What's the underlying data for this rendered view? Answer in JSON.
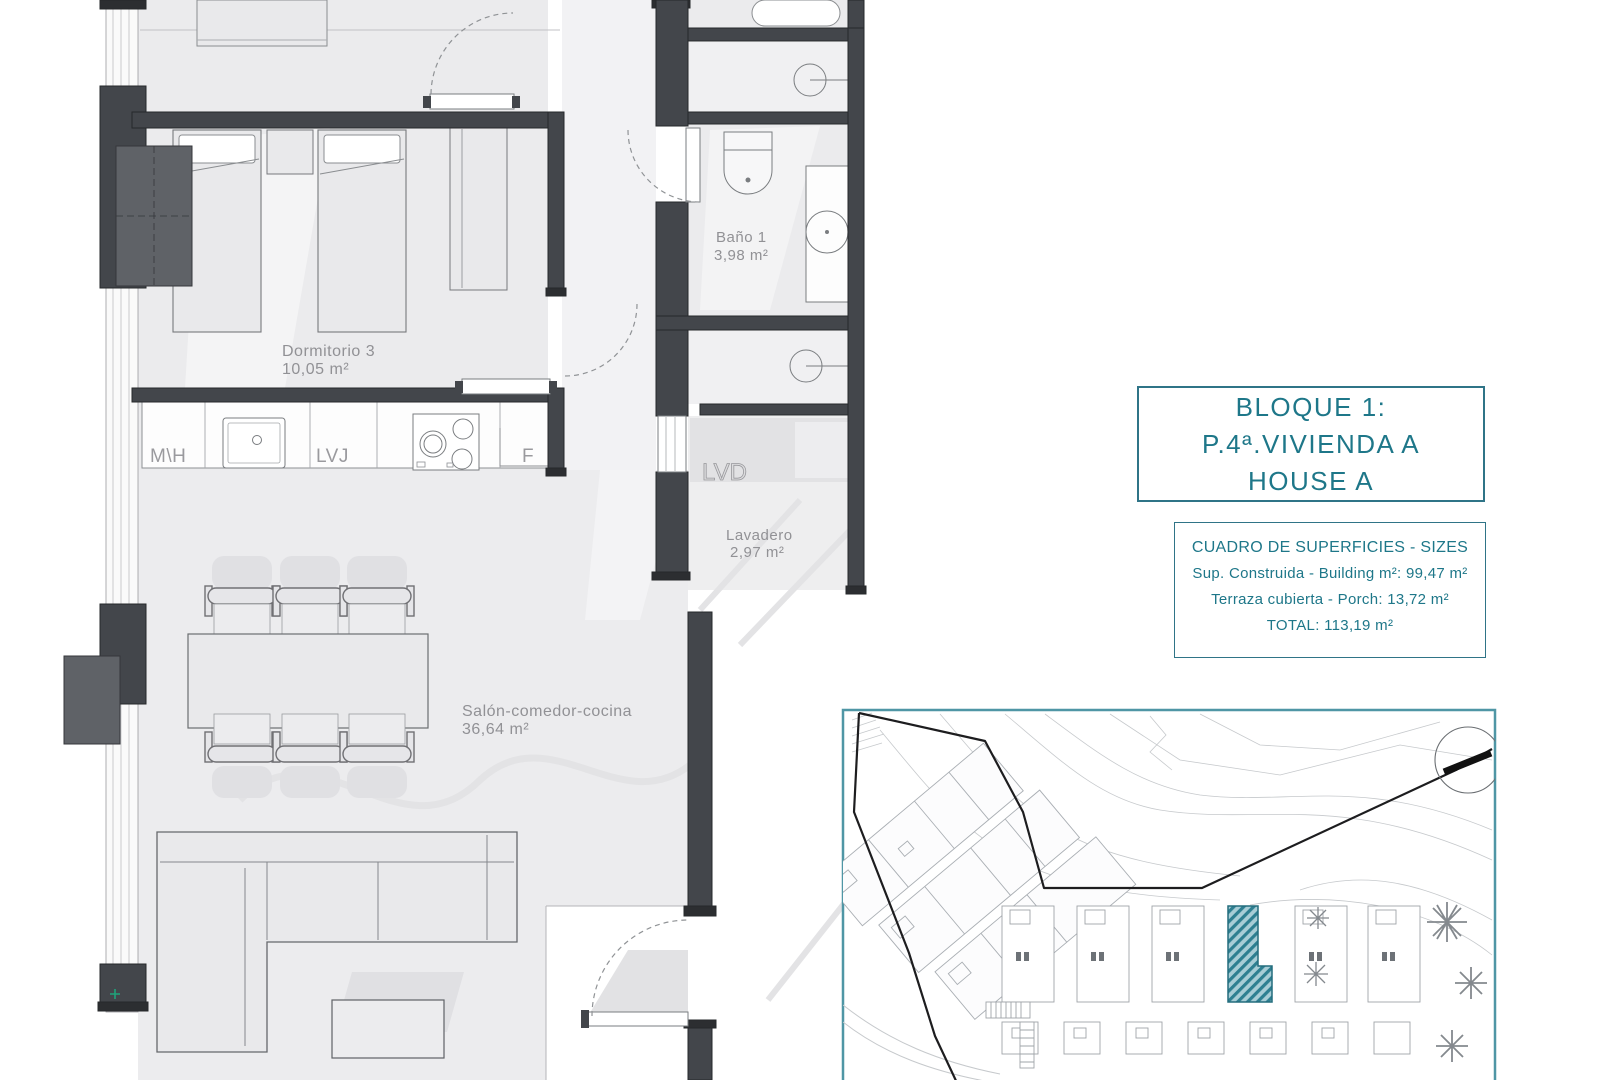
{
  "plan": {
    "rooms": [
      {
        "name": "Dormitorio 3",
        "area": "10,05 m²"
      },
      {
        "name": "Baño 1",
        "area": "3,98 m²"
      },
      {
        "name": "Lavadero",
        "area": "2,97 m²"
      },
      {
        "name": "Salón-comedor-cocina",
        "area": "36,64 m²"
      }
    ],
    "appliances": {
      "microwave_oven": "M\\H",
      "dishwasher": "LVJ",
      "fridge": "F",
      "washer": "LVD"
    }
  },
  "info_box": {
    "line1": "BLOQUE 1:",
    "line2": "P.4ª.VIVIENDA A",
    "line3": "HOUSE A"
  },
  "sizes_table": {
    "title": "CUADRO DE SUPERFICIES  - SIZES",
    "row1": "Sup. Construida  -  Building m²: 99,47 m²",
    "row2": "Terraza cubierta  -  Porch: 13,72 m²",
    "total": "TOTAL:  113,19 m²"
  },
  "colors": {
    "accent_teal": "#1e7789",
    "wall_dark": "#43464b",
    "room_fill": "#ebebed",
    "unit_hatch": "#2e7f91"
  }
}
